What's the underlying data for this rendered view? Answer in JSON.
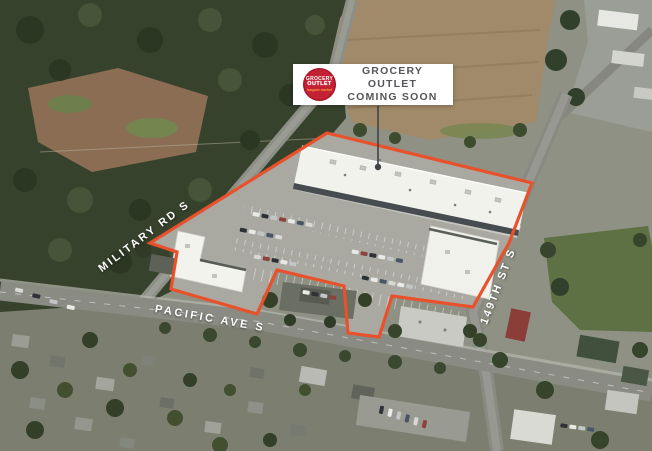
{
  "callout": {
    "line1": "GROCERY OUTLET",
    "line2": "COMING SOON"
  },
  "logo": {
    "word1": "GROCERY",
    "word2": "OUTLET",
    "tagline": "bargain market"
  },
  "streets": {
    "military": "MILITARY RD S",
    "pacific": "PACIFIC AVE S",
    "st149": "149TH ST S"
  },
  "colors": {
    "outline_orange": "#e8512b",
    "logo_red": "#c52134",
    "logo_tagline_orange": "#f2a03c",
    "callout_text_gray": "#55565a",
    "street_label_white": "#ffffff"
  }
}
